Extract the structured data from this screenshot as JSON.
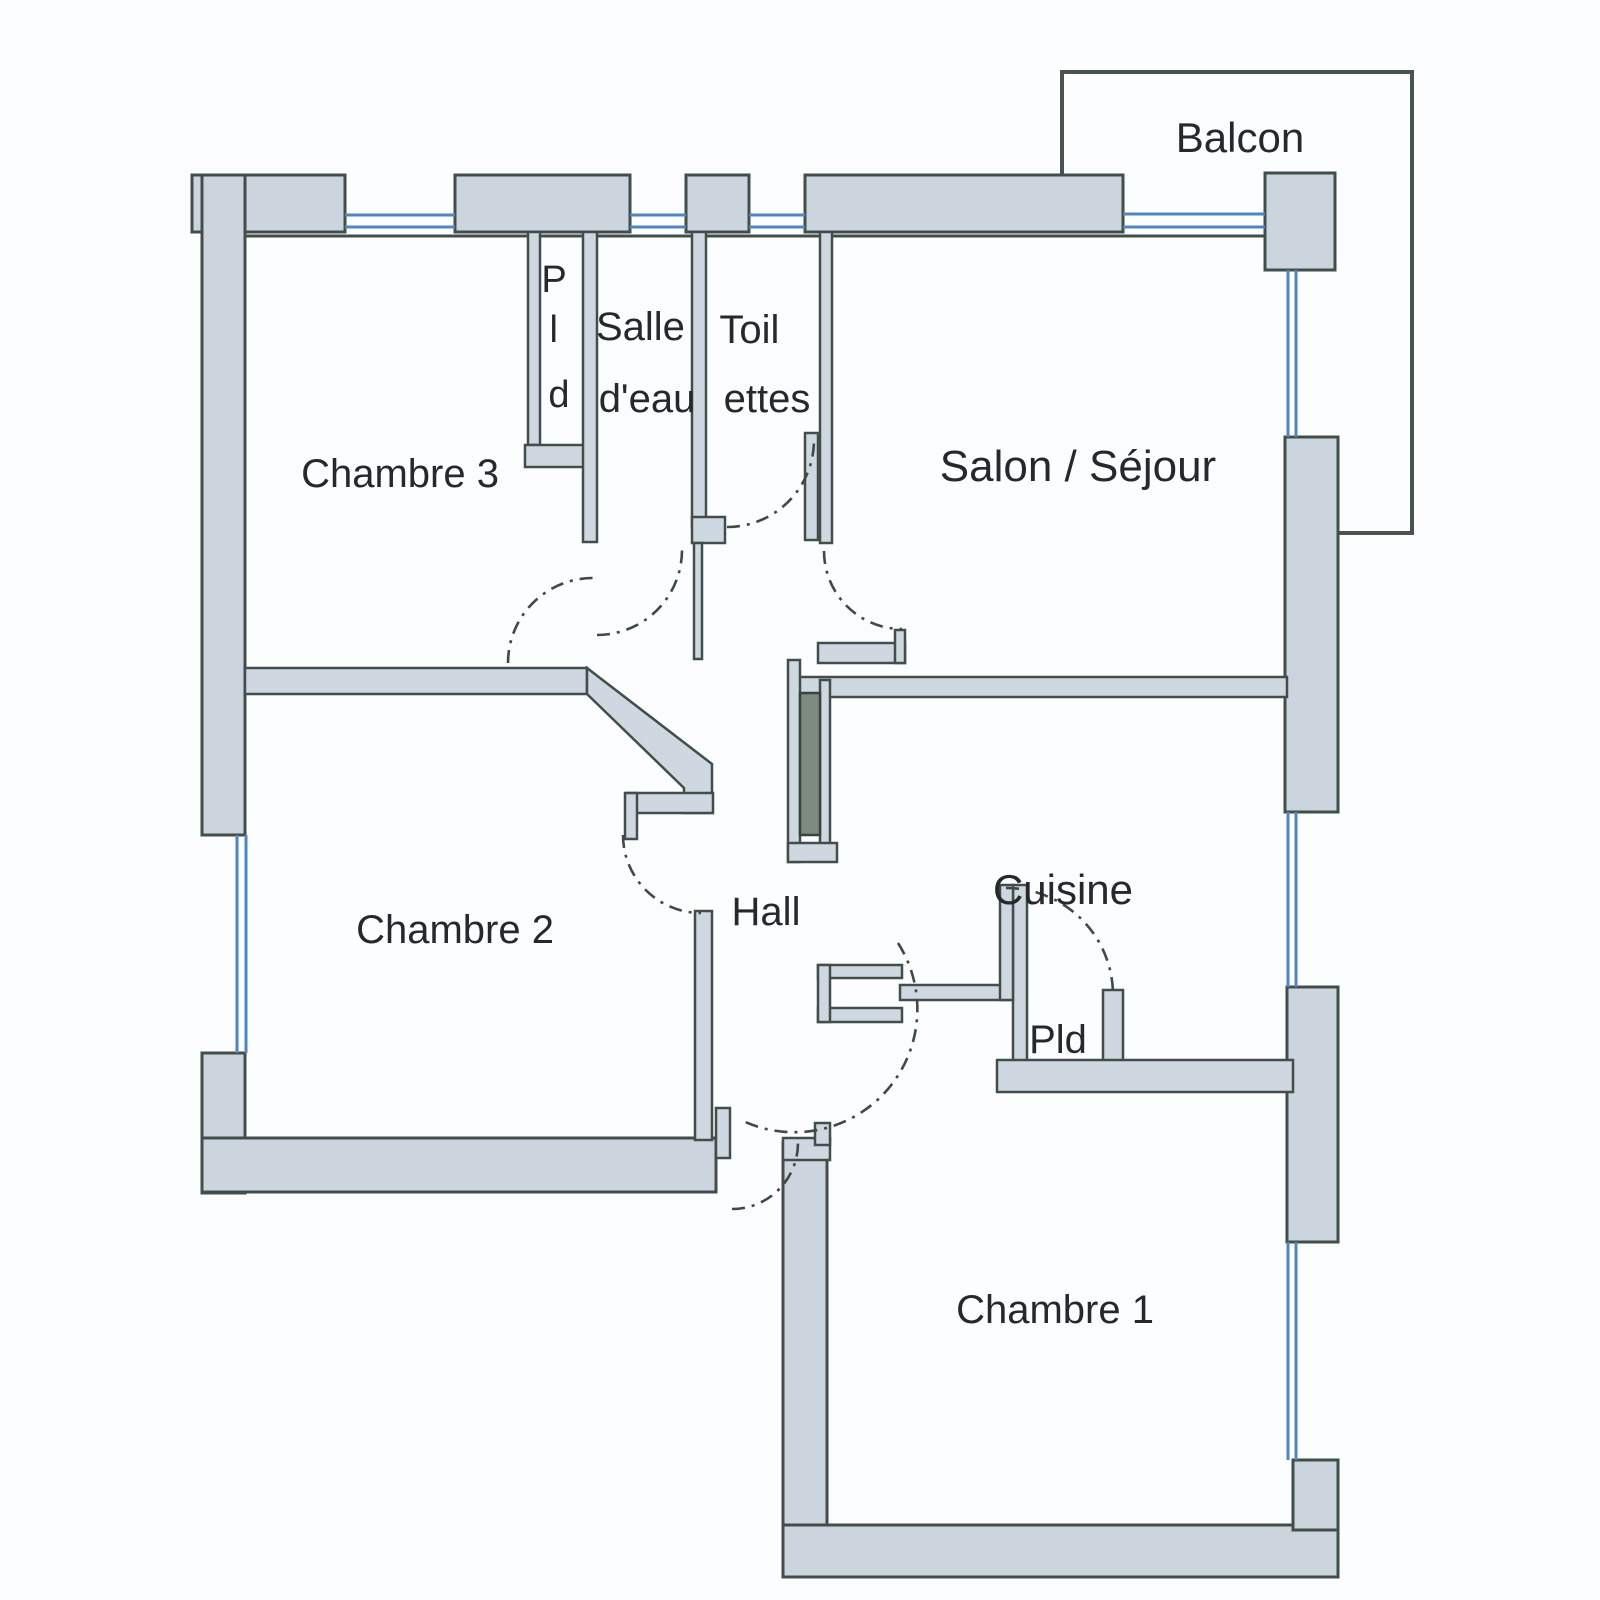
{
  "floor_plan": {
    "type": "apartment-floor-plan",
    "rooms": {
      "balcon": {
        "label": "Balcon"
      },
      "chambre_3": {
        "label": "Chambre 3"
      },
      "pld_chambre_3": {
        "letters": [
          "P",
          "l",
          "d"
        ]
      },
      "salle_deau": {
        "line1": "Salle",
        "line2": "d'eau"
      },
      "toilettes": {
        "line1": "Toil",
        "line2": "ettes"
      },
      "salon_sejour": {
        "label": "Salon / Séjour"
      },
      "cuisine": {
        "label": "Cuisine"
      },
      "pld_cuisine": {
        "label": "Pld"
      },
      "hall": {
        "label": "Hall"
      },
      "chambre_2": {
        "label": "Chambre 2"
      },
      "chambre_1": {
        "label": "Chambre 1"
      }
    },
    "colors": {
      "background": "#fcfdfe",
      "wall_fill": "#ccd5de",
      "wall_outline": "#414e49",
      "window_blue": "#4f86c2",
      "door_leaf_dark": "#7d8a7f",
      "text": "#26292b"
    }
  }
}
